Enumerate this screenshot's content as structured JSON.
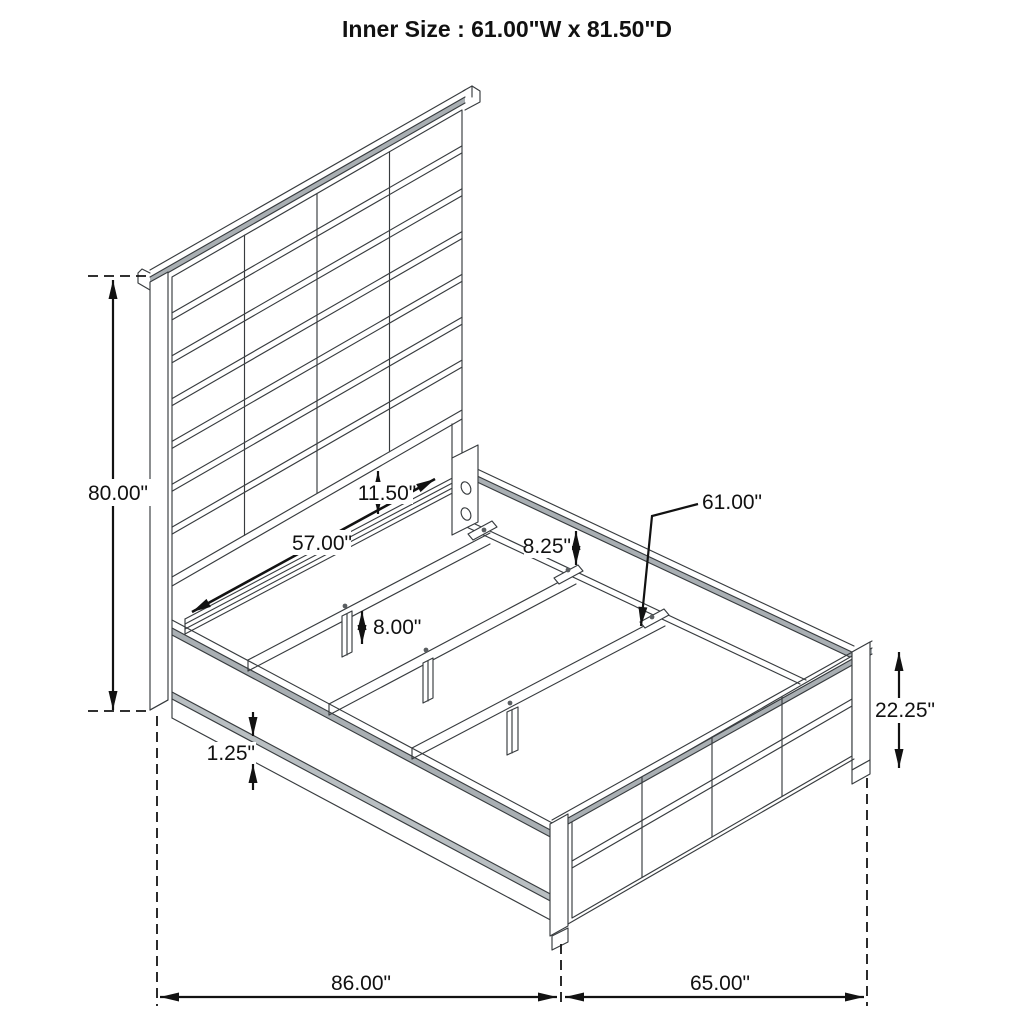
{
  "title": "Inner Size : 61.00\"W x 81.50\"D",
  "dimensions": {
    "overall_height": "80.00\"",
    "headboard_panel_width": "57.00\"",
    "headboard_clearance": "11.50\"",
    "rail_above_slat": "8.25\"",
    "slat_length": "61.00\"",
    "center_leg_height": "8.00\"",
    "side_rail_lip": "1.25\"",
    "footboard_height": "22.25\"",
    "overall_depth": "86.00\"",
    "overall_width": "65.00\""
  }
}
